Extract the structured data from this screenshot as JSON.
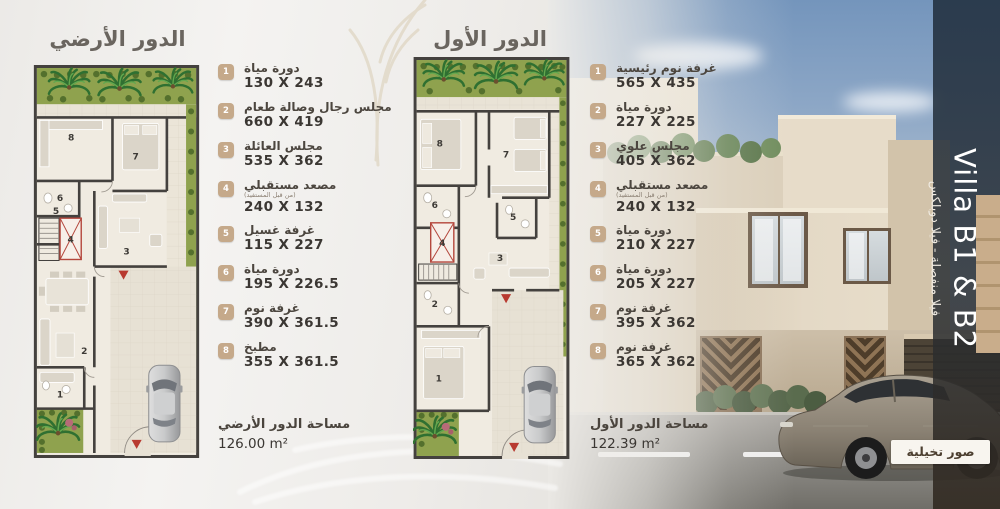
{
  "ground_floor": {
    "title": "الدور الأرضي",
    "area_label": "مساحة الدور الأرضي",
    "area_value": "126.00 m²",
    "items": [
      {
        "num": "1",
        "name": "دورة مياة",
        "dims": "130 X 243"
      },
      {
        "num": "2",
        "name": "مجلس رجال وصالة طعام",
        "dims": "660 X 419"
      },
      {
        "num": "3",
        "name": "مجلس العائلة",
        "dims": "535 X 362"
      },
      {
        "num": "4",
        "name": "مصعد مستقبلي",
        "note": "(من قبل المستفيد)",
        "dims": "240 X 132"
      },
      {
        "num": "5",
        "name": "غرفة غسيل",
        "dims": "115 X 227"
      },
      {
        "num": "6",
        "name": "دورة مياة",
        "dims": "195 X 226.5"
      },
      {
        "num": "7",
        "name": "غرفة نوم",
        "dims": "390 X 361.5"
      },
      {
        "num": "8",
        "name": "مطبخ",
        "dims": "355 X 361.5"
      }
    ]
  },
  "first_floor": {
    "title": "الدور الأول",
    "area_label": "مساحة الدور الأول",
    "area_value": "122.39 m²",
    "items": [
      {
        "num": "1",
        "name": "غرفة نوم رئيسية",
        "dims": "565 X 435"
      },
      {
        "num": "2",
        "name": "دورة مياة",
        "dims": "227 X 225"
      },
      {
        "num": "3",
        "name": "مجلس علوي",
        "dims": "405 X 362"
      },
      {
        "num": "4",
        "name": "مصعد مستقبلي",
        "note": "(من قبل المستفيد)",
        "dims": "240 X 132"
      },
      {
        "num": "5",
        "name": "دورة مياة",
        "dims": "210 X 227"
      },
      {
        "num": "6",
        "name": "دورة مياة",
        "dims": "205 X 227"
      },
      {
        "num": "7",
        "name": "غرفة نوم",
        "dims": "395 X 362"
      },
      {
        "num": "8",
        "name": "غرفة نوم",
        "dims": "365 X 362"
      }
    ]
  },
  "villa": {
    "name": "Villa B1 & B2",
    "subtitle": "فيلا منفصلة - فيلا دوبلكس",
    "disclaimer": "صور تخيلية"
  },
  "colors": {
    "badge": "#c5a98a",
    "garden_green": "#8fa24e",
    "wall_dark": "#44413e",
    "accent_red": "#b4473d"
  }
}
